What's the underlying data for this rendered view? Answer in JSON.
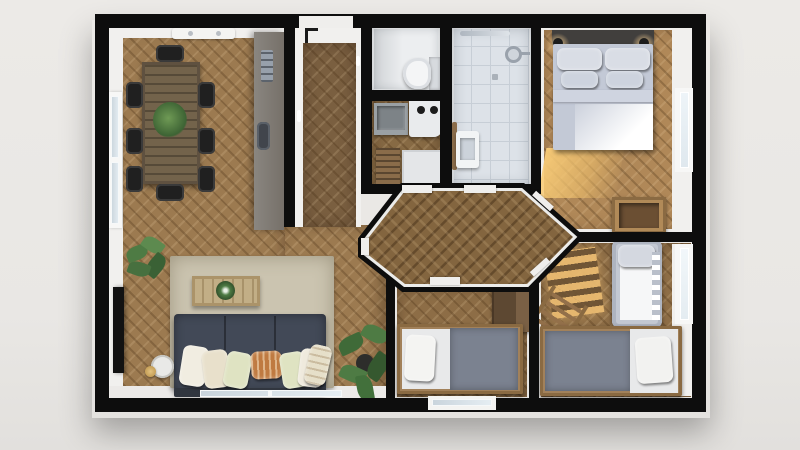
{
  "meta": {
    "description": "3D rendered top-down floor plan of an apartment with living-dining room, entry hall, WC, kitchen, bathroom, master bedroom, hexagonal hallway and two children's rooms",
    "render_style": "architectural dollhouse top view"
  },
  "palette": {
    "background": "#e9e8e5",
    "walls": "#0d0d0d",
    "wood_living": "#9c7a50",
    "wood_hall": "#7a5f40",
    "wood_bedroom": "#b08858",
    "wood_kids": "#8d6d46",
    "bathroom_tile": "#dde2e8",
    "wc_floor": "#eceef0",
    "rug": "#cbc4b0",
    "sofa": "#424957",
    "bed_linen": "#c9cfdb",
    "blanket_gray": "#7b8290",
    "wood_furniture": "#a2815a",
    "sunlight": "#f0c880",
    "plant_green": "#4e7b44",
    "accent_pillow": "#bf7a41"
  },
  "rooms": [
    {
      "id": "living-dining",
      "label": "Living / dining room",
      "furniture": [
        "dining-table",
        "dining-chairs",
        "rug",
        "sofa",
        "throw-pillows",
        "coffee-table",
        "tv",
        "side-table",
        "floor-lamp",
        "plants",
        "tall-cabinet"
      ]
    },
    {
      "id": "entry-hall",
      "label": "Entry hall",
      "furniture": [
        "entry-door"
      ]
    },
    {
      "id": "wc",
      "label": "WC",
      "furniture": [
        "toilet"
      ]
    },
    {
      "id": "kitchen",
      "label": "Kitchen",
      "furniture": [
        "sink-counter",
        "cooktop",
        "base-cabinet",
        "runner-mat"
      ]
    },
    {
      "id": "bathroom",
      "label": "Bathroom",
      "furniture": [
        "shower-head",
        "wash-basin",
        "ceiling-light",
        "towel-rail"
      ]
    },
    {
      "id": "master-bedroom",
      "label": "Master bedroom",
      "furniture": [
        "double-bed",
        "headboard",
        "wall-lamps",
        "dresser"
      ]
    },
    {
      "id": "hallway",
      "label": "Hallway",
      "furniture": []
    },
    {
      "id": "kids-room-1",
      "label": "Kids room",
      "furniture": [
        "single-bed",
        "wardrobe"
      ]
    },
    {
      "id": "nursery",
      "label": "Nursery",
      "furniture": [
        "single-bed",
        "crib",
        "ladder"
      ]
    }
  ],
  "openings": {
    "doors": [
      "entry-door",
      "living-to-hallway",
      "kitchen-to-hallway",
      "bathroom-to-hallway",
      "bedroom-to-hallway",
      "kids-room-to-hallway",
      "nursery-to-hallway"
    ],
    "windows": [
      "living-left-window",
      "dining-skylight",
      "living-bottom-window",
      "kids-room-bottom-window",
      "bedroom-right-window",
      "nursery-right-window"
    ]
  }
}
